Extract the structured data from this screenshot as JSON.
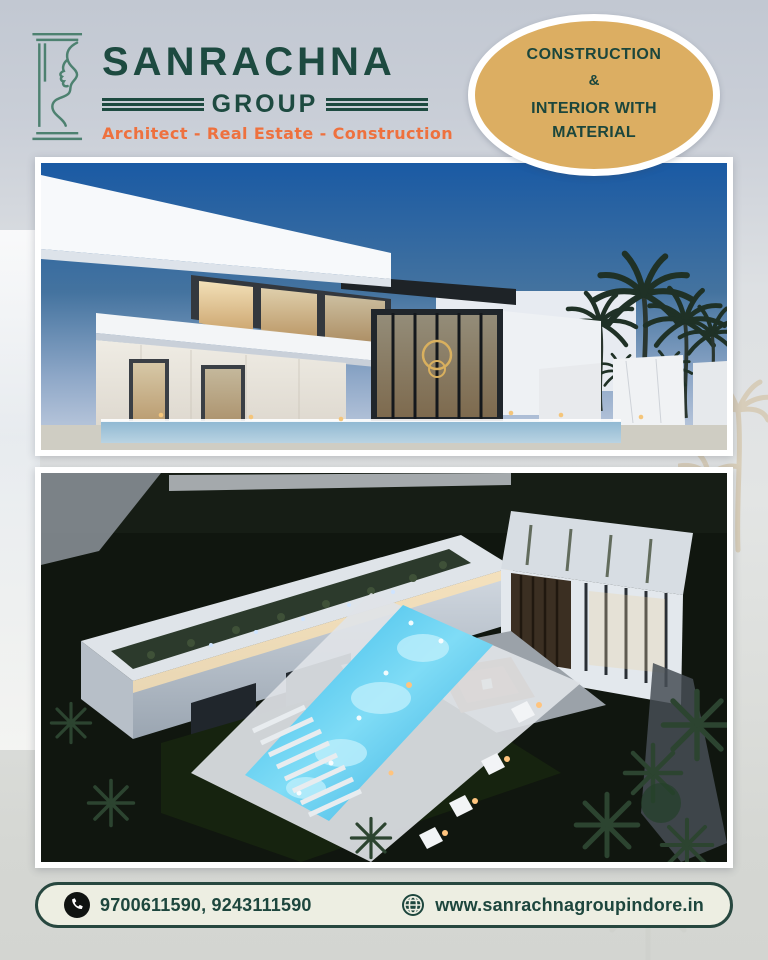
{
  "brand": {
    "name": "SANRACHNA",
    "group": "GROUP",
    "tagline": "Architect - Real Estate - Construction"
  },
  "badge": {
    "lines": [
      "CONSTRUCTION",
      "&",
      "INTERIOR WITH",
      "MATERIAL"
    ]
  },
  "gallery": {
    "photo1_name": "villa-dusk-exterior",
    "photo2_name": "villa-night-aerial"
  },
  "footer": {
    "phone_numbers": "9700611590, 9243111590",
    "website": "www.sanrachnagroupindore.in"
  },
  "colors": {
    "brand_green": "#1d4a40",
    "logo_line_green": "#4d8170",
    "accent_orange": "#ee713e",
    "badge_gold": "#dcae62",
    "page_background": "#c9ced7",
    "footer_background": "#edeee2",
    "pool_glow": "#3ec1ee"
  }
}
